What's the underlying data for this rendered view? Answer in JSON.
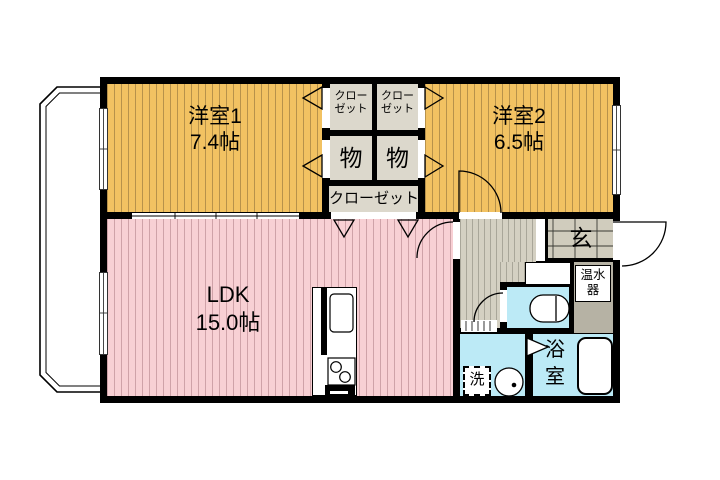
{
  "floorplan": {
    "type": "apartment-floorplan",
    "rooms": {
      "bedroom1": {
        "name": "洋室1",
        "area": "7.4帖"
      },
      "bedroom2": {
        "name": "洋室2",
        "area": "6.5帖"
      },
      "ldk": {
        "name": "LDK",
        "area": "15.0帖"
      },
      "closet_left": {
        "line1": "クロー",
        "line2": "ゼット"
      },
      "closet_right": {
        "line1": "クロー",
        "line2": "ゼット"
      },
      "storage_left": "物",
      "storage_right": "物",
      "closet_wide": "クローゼット",
      "entrance": "玄",
      "water_heater": {
        "line1": "温水",
        "line2": "器"
      },
      "bathroom": {
        "line1": "浴",
        "line2": "室"
      },
      "laundry": "洗"
    },
    "colors": {
      "bedroom_fill": "#f2c262",
      "ldk_fill": "#f8d0d4",
      "wet_area_fill": "#bceaf6",
      "closet_fill": "#dcd8cc",
      "hallway_fill": "#d4d0c2",
      "entrance_tile": "#d0ccbd",
      "water_heater_fill": "#b6b2a4",
      "wall": "#000000",
      "background": "#ffffff"
    }
  }
}
